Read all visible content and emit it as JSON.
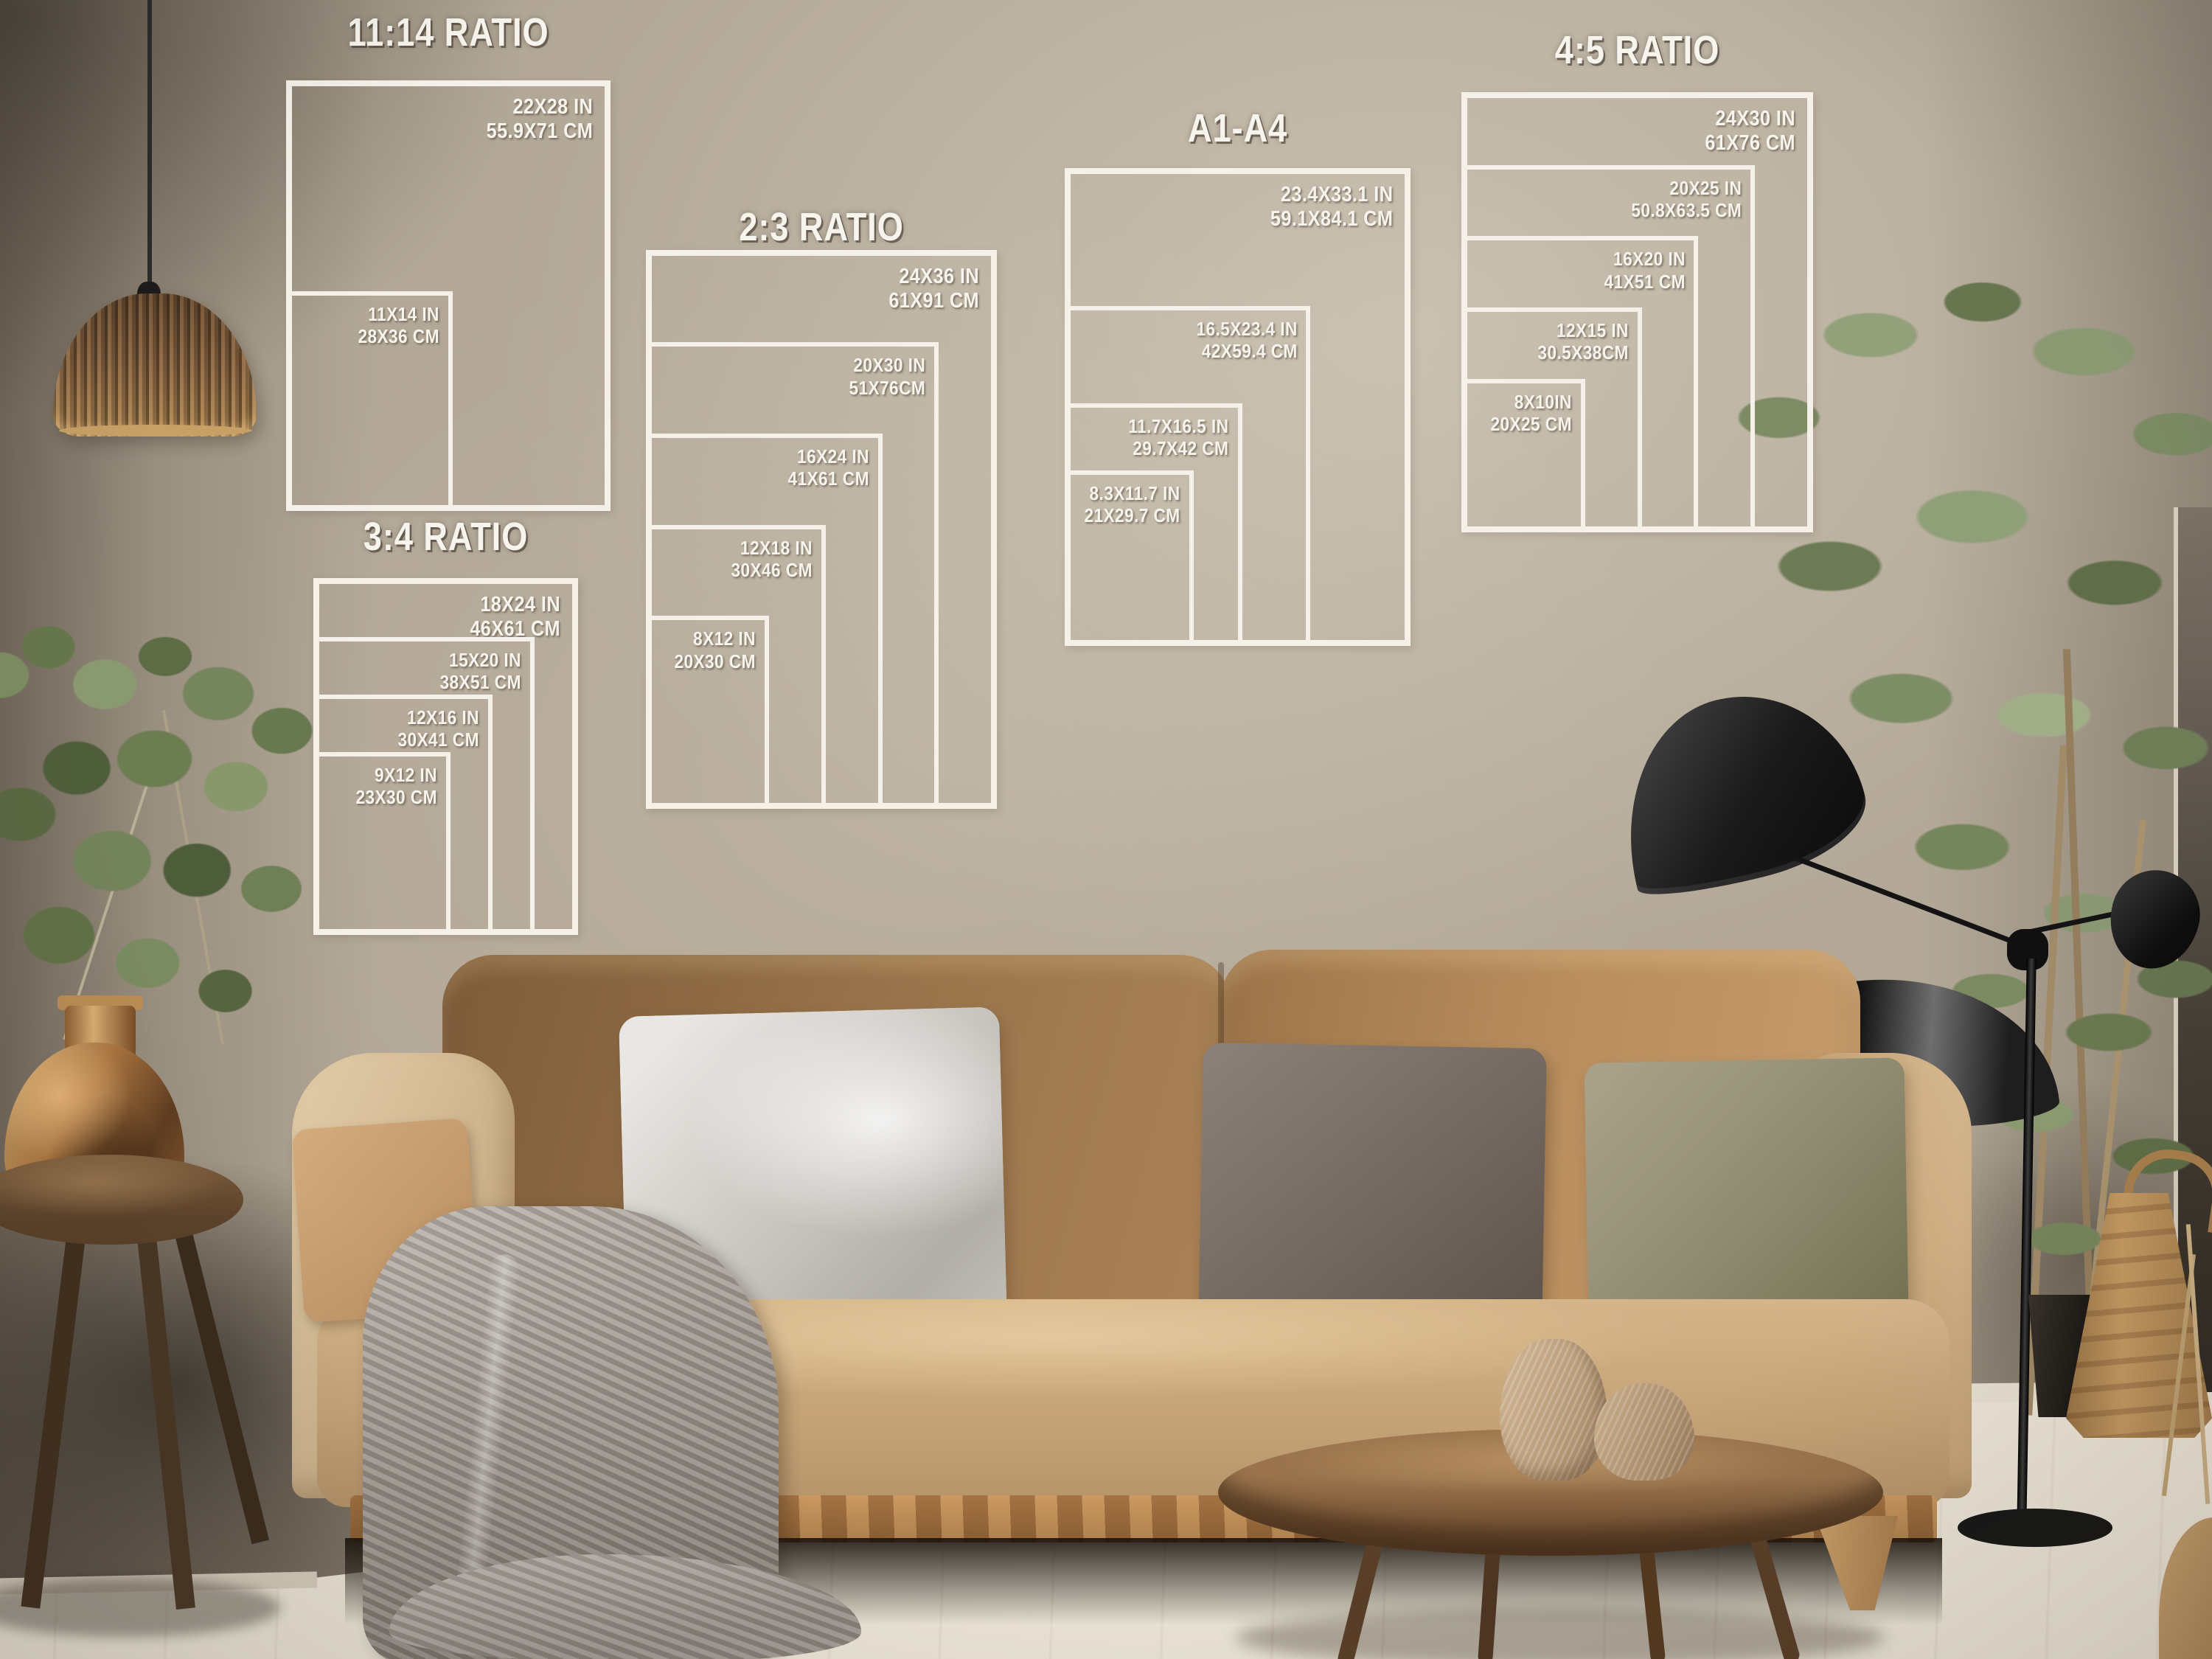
{
  "scene": {
    "overlay_line_color": "#f5f1e8",
    "overlay_text_color": "#f7f4ee",
    "wall_color": "#b3a897",
    "floor_color": "#e9e1d4",
    "sofa_color": "#c5a377"
  },
  "charts": [
    {
      "title": "11:14 RATIO",
      "sizes": [
        {
          "inches": "22X28 IN",
          "cm": "55.9X71 CM",
          "w": 22,
          "h": 28
        },
        {
          "inches": "11X14 IN",
          "cm": "28X36 CM",
          "w": 11,
          "h": 14
        }
      ]
    },
    {
      "title": "2:3 RATIO",
      "sizes": [
        {
          "inches": "24X36 IN",
          "cm": "61X91 CM",
          "w": 24,
          "h": 36
        },
        {
          "inches": "20X30 IN",
          "cm": "51X76CM",
          "w": 20,
          "h": 30
        },
        {
          "inches": "16X24 IN",
          "cm": "41X61 CM",
          "w": 16,
          "h": 24
        },
        {
          "inches": "12X18 IN",
          "cm": "30X46 CM",
          "w": 12,
          "h": 18
        },
        {
          "inches": "8X12 IN",
          "cm": "20X30 CM",
          "w": 8,
          "h": 12
        }
      ]
    },
    {
      "title": "3:4 RATIO",
      "sizes": [
        {
          "inches": "18X24 IN",
          "cm": "46X61 CM",
          "w": 18,
          "h": 24
        },
        {
          "inches": "15X20 IN",
          "cm": "38X51 CM",
          "w": 15,
          "h": 20
        },
        {
          "inches": "12X16 IN",
          "cm": "30X41 CM",
          "w": 12,
          "h": 16
        },
        {
          "inches": "9X12 IN",
          "cm": "23X30 CM",
          "w": 9,
          "h": 12
        }
      ]
    },
    {
      "title": "A1-A4",
      "sizes": [
        {
          "inches": "23.4X33.1 IN",
          "cm": "59.1X84.1 CM",
          "w": 23.4,
          "h": 33.1
        },
        {
          "inches": "16.5X23.4 IN",
          "cm": "42X59.4 CM",
          "w": 16.5,
          "h": 23.4
        },
        {
          "inches": "11.7X16.5 IN",
          "cm": "29.7X42 CM",
          "w": 11.7,
          "h": 16.5
        },
        {
          "inches": "8.3X11.7 IN",
          "cm": "21X29.7 CM",
          "w": 8.3,
          "h": 11.7
        }
      ]
    },
    {
      "title": "4:5 RATIO",
      "sizes": [
        {
          "inches": "24X30 IN",
          "cm": "61X76 CM",
          "w": 24,
          "h": 30
        },
        {
          "inches": "20X25 IN",
          "cm": "50.8X63.5 CM",
          "w": 20,
          "h": 25
        },
        {
          "inches": "16X20 IN",
          "cm": "41X51 CM",
          "w": 16,
          "h": 20
        },
        {
          "inches": "12X15 IN",
          "cm": "30.5X38CM",
          "w": 12,
          "h": 15
        },
        {
          "inches": "8X10IN",
          "cm": "20X25 CM",
          "w": 8,
          "h": 10
        }
      ]
    }
  ]
}
